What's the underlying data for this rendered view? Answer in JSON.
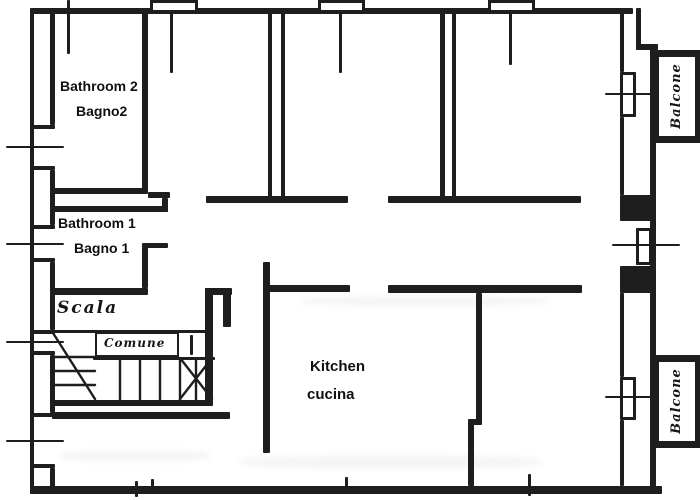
{
  "title": "Apartment floor plan (scan)",
  "ink_color": "#1e1e1e",
  "background_color": "#ffffff",
  "labels": {
    "bathroom2": {
      "en": "Bathroom 2",
      "it": "Bagno2"
    },
    "bathroom1": {
      "en": "Bathroom 1",
      "it": "Bagno 1"
    },
    "kitchen": {
      "en": "Kitchen",
      "it": "cucina"
    },
    "stairs": {
      "it": "Scala"
    },
    "common": {
      "it": "Comune"
    },
    "balcony_top": {
      "it": "Balcone"
    },
    "balcony_bottom": {
      "it": "Balcone"
    }
  }
}
